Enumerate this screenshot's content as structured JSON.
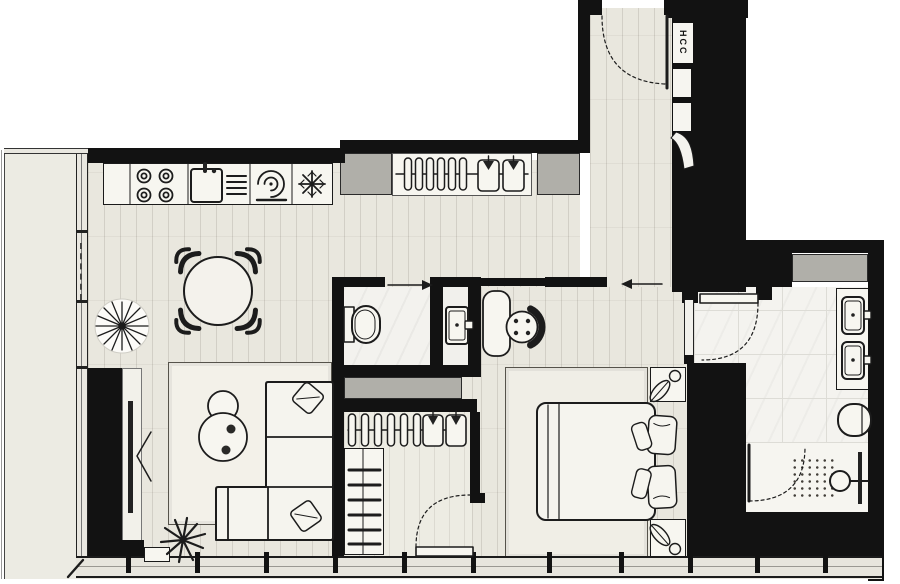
{
  "plan": {
    "shaft_label": "HCC",
    "colors": {
      "wall": "#121212",
      "wood_floor": "#e9e7de",
      "tile_floor": "#f4f3ef",
      "gray_block": "#b0afa9",
      "furniture_fill": "#f7f6f0",
      "line": "#1c1c1c",
      "rug": "#f3f1e9",
      "background": "#ffffff"
    },
    "rooms": [
      {
        "name": "balcony",
        "fixtures": [
          "sliding-window"
        ]
      },
      {
        "name": "kitchen-dining",
        "fixtures": [
          "cooktop-4-burners",
          "kitchen-sink-with-faucet",
          "dish-rack",
          "extractor-swirl",
          "refrigerator-snowflake",
          "round-dining-table",
          "four-chairs",
          "potted-plant"
        ]
      },
      {
        "name": "living-room",
        "fixtures": [
          "tv-on-media-wall",
          "corner-sofa",
          "two-cushions",
          "two-round-coffee-tables",
          "two-cups",
          "plant"
        ]
      },
      {
        "name": "entry-hall",
        "fixtures": [
          "entrance-door",
          "coat-closet-hangers",
          "two-shirts",
          "utility-shaft"
        ]
      },
      {
        "name": "wc",
        "fixtures": [
          "toilet",
          "washbasin"
        ]
      },
      {
        "name": "dressing-corner",
        "fixtures": [
          "dressing-table",
          "stool"
        ]
      },
      {
        "name": "walk-in-closet",
        "fixtures": [
          "hanger-rail",
          "six-hangers",
          "two-shirts",
          "shelf-unit",
          "swing-door"
        ]
      },
      {
        "name": "bedroom",
        "fixtures": [
          "double-bed",
          "four-pillows",
          "rug",
          "two-nightstands",
          "two-plants"
        ]
      },
      {
        "name": "master-bathroom",
        "fixtures": [
          "double-washbasin",
          "toilet",
          "shower-head",
          "shower-door",
          "storage-niche",
          "swing-door"
        ]
      }
    ]
  }
}
